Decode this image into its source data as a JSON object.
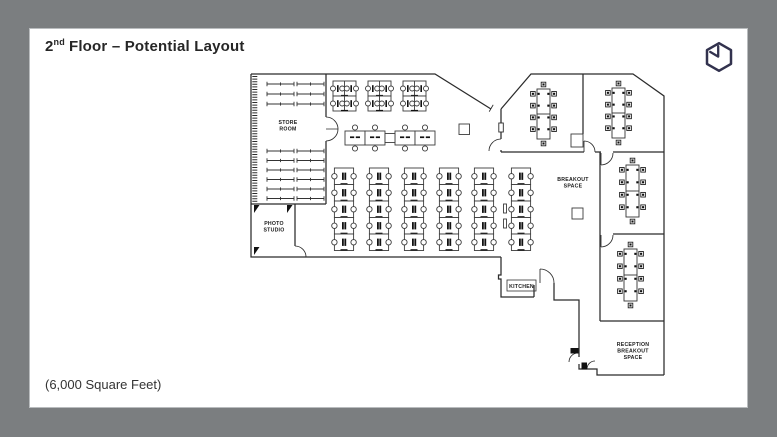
{
  "slide": {
    "title": {
      "number": "2",
      "ordinal": "nd",
      "rest": "Floor – Potential Layout"
    },
    "footer": "(6,000 Square Feet)"
  },
  "logo": {
    "name": "hexagon-cube-logo",
    "color": "#32324e"
  },
  "colors": {
    "frame": "#7b7e80",
    "slide": "#ffffff",
    "wall": "#2b2b2b",
    "furniture": "#3c3c3c",
    "text": "#262626"
  },
  "floorplan": {
    "labels": {
      "store_room": [
        "STORE",
        "ROOM"
      ],
      "photo_studio": [
        "PHOTO",
        "STUDIO"
      ],
      "breakout": [
        "BREAKOUT",
        "SPACE"
      ],
      "kitchen": [
        "KITCHEN"
      ],
      "reception": [
        "RECEPTION",
        "BREAKOUT",
        "SPACE"
      ]
    }
  }
}
